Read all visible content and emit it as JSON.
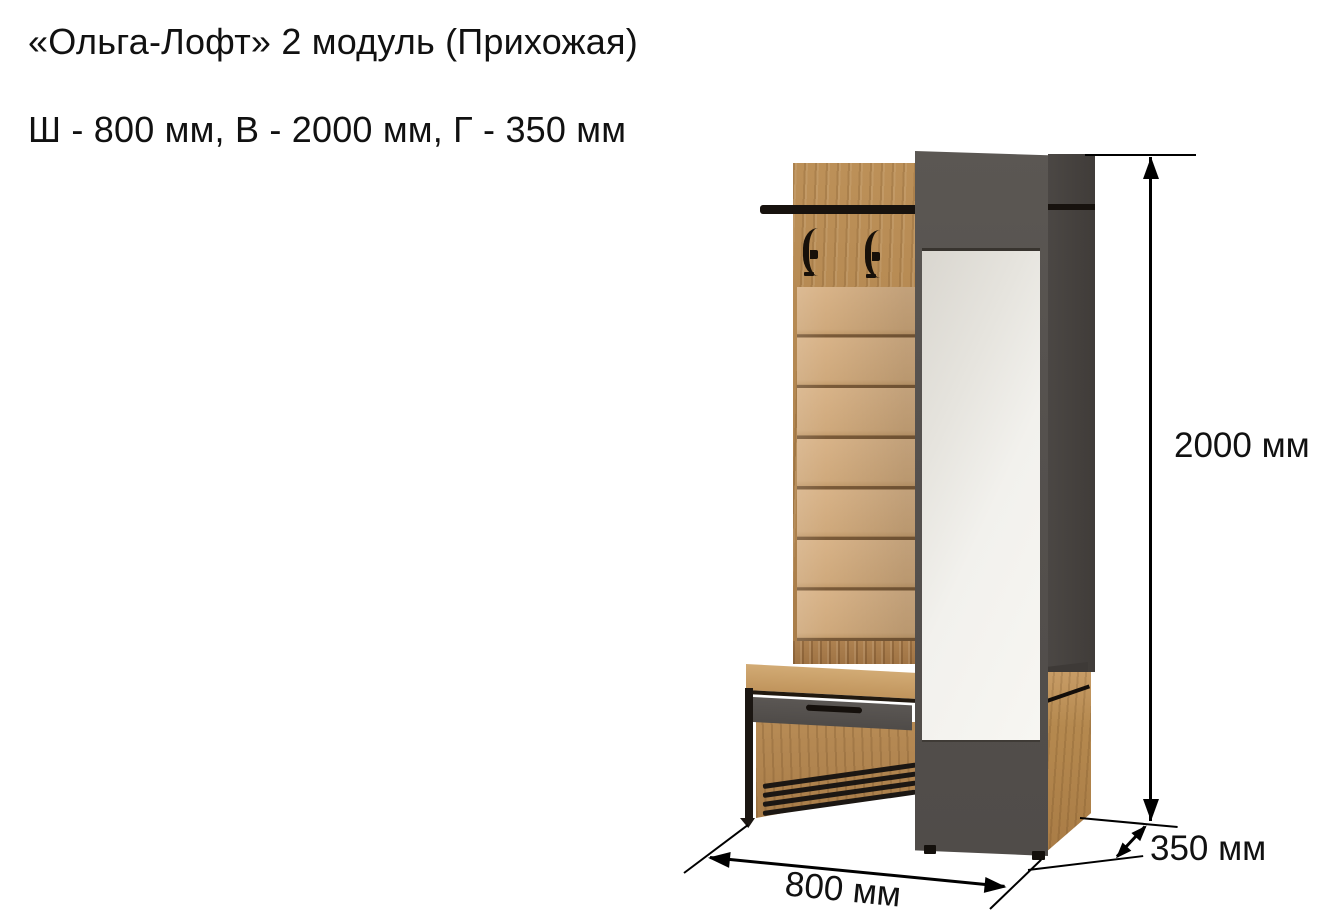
{
  "header": {
    "title": "«Ольга-Лофт» 2 модуль (Прихожая)",
    "subtitle": "Ш - 800 мм, В - 2000 мм, Г - 350 мм"
  },
  "dimensions": {
    "height_label": "2000 мм",
    "width_label": "800 мм",
    "depth_label": "350 мм"
  },
  "product": {
    "name": "«Ольга-Лофт» 2 модуль",
    "category": "Прихожая"
  },
  "colors": {
    "background": "#ffffff",
    "text": "#111111",
    "oak_wood": "#b58a53",
    "upholstery_tan": "#d3ad80",
    "panel_gray": "#55514e",
    "side_gray": "#45413e",
    "frame_black": "#17120e",
    "mirror_light": "#f2f1ed"
  }
}
